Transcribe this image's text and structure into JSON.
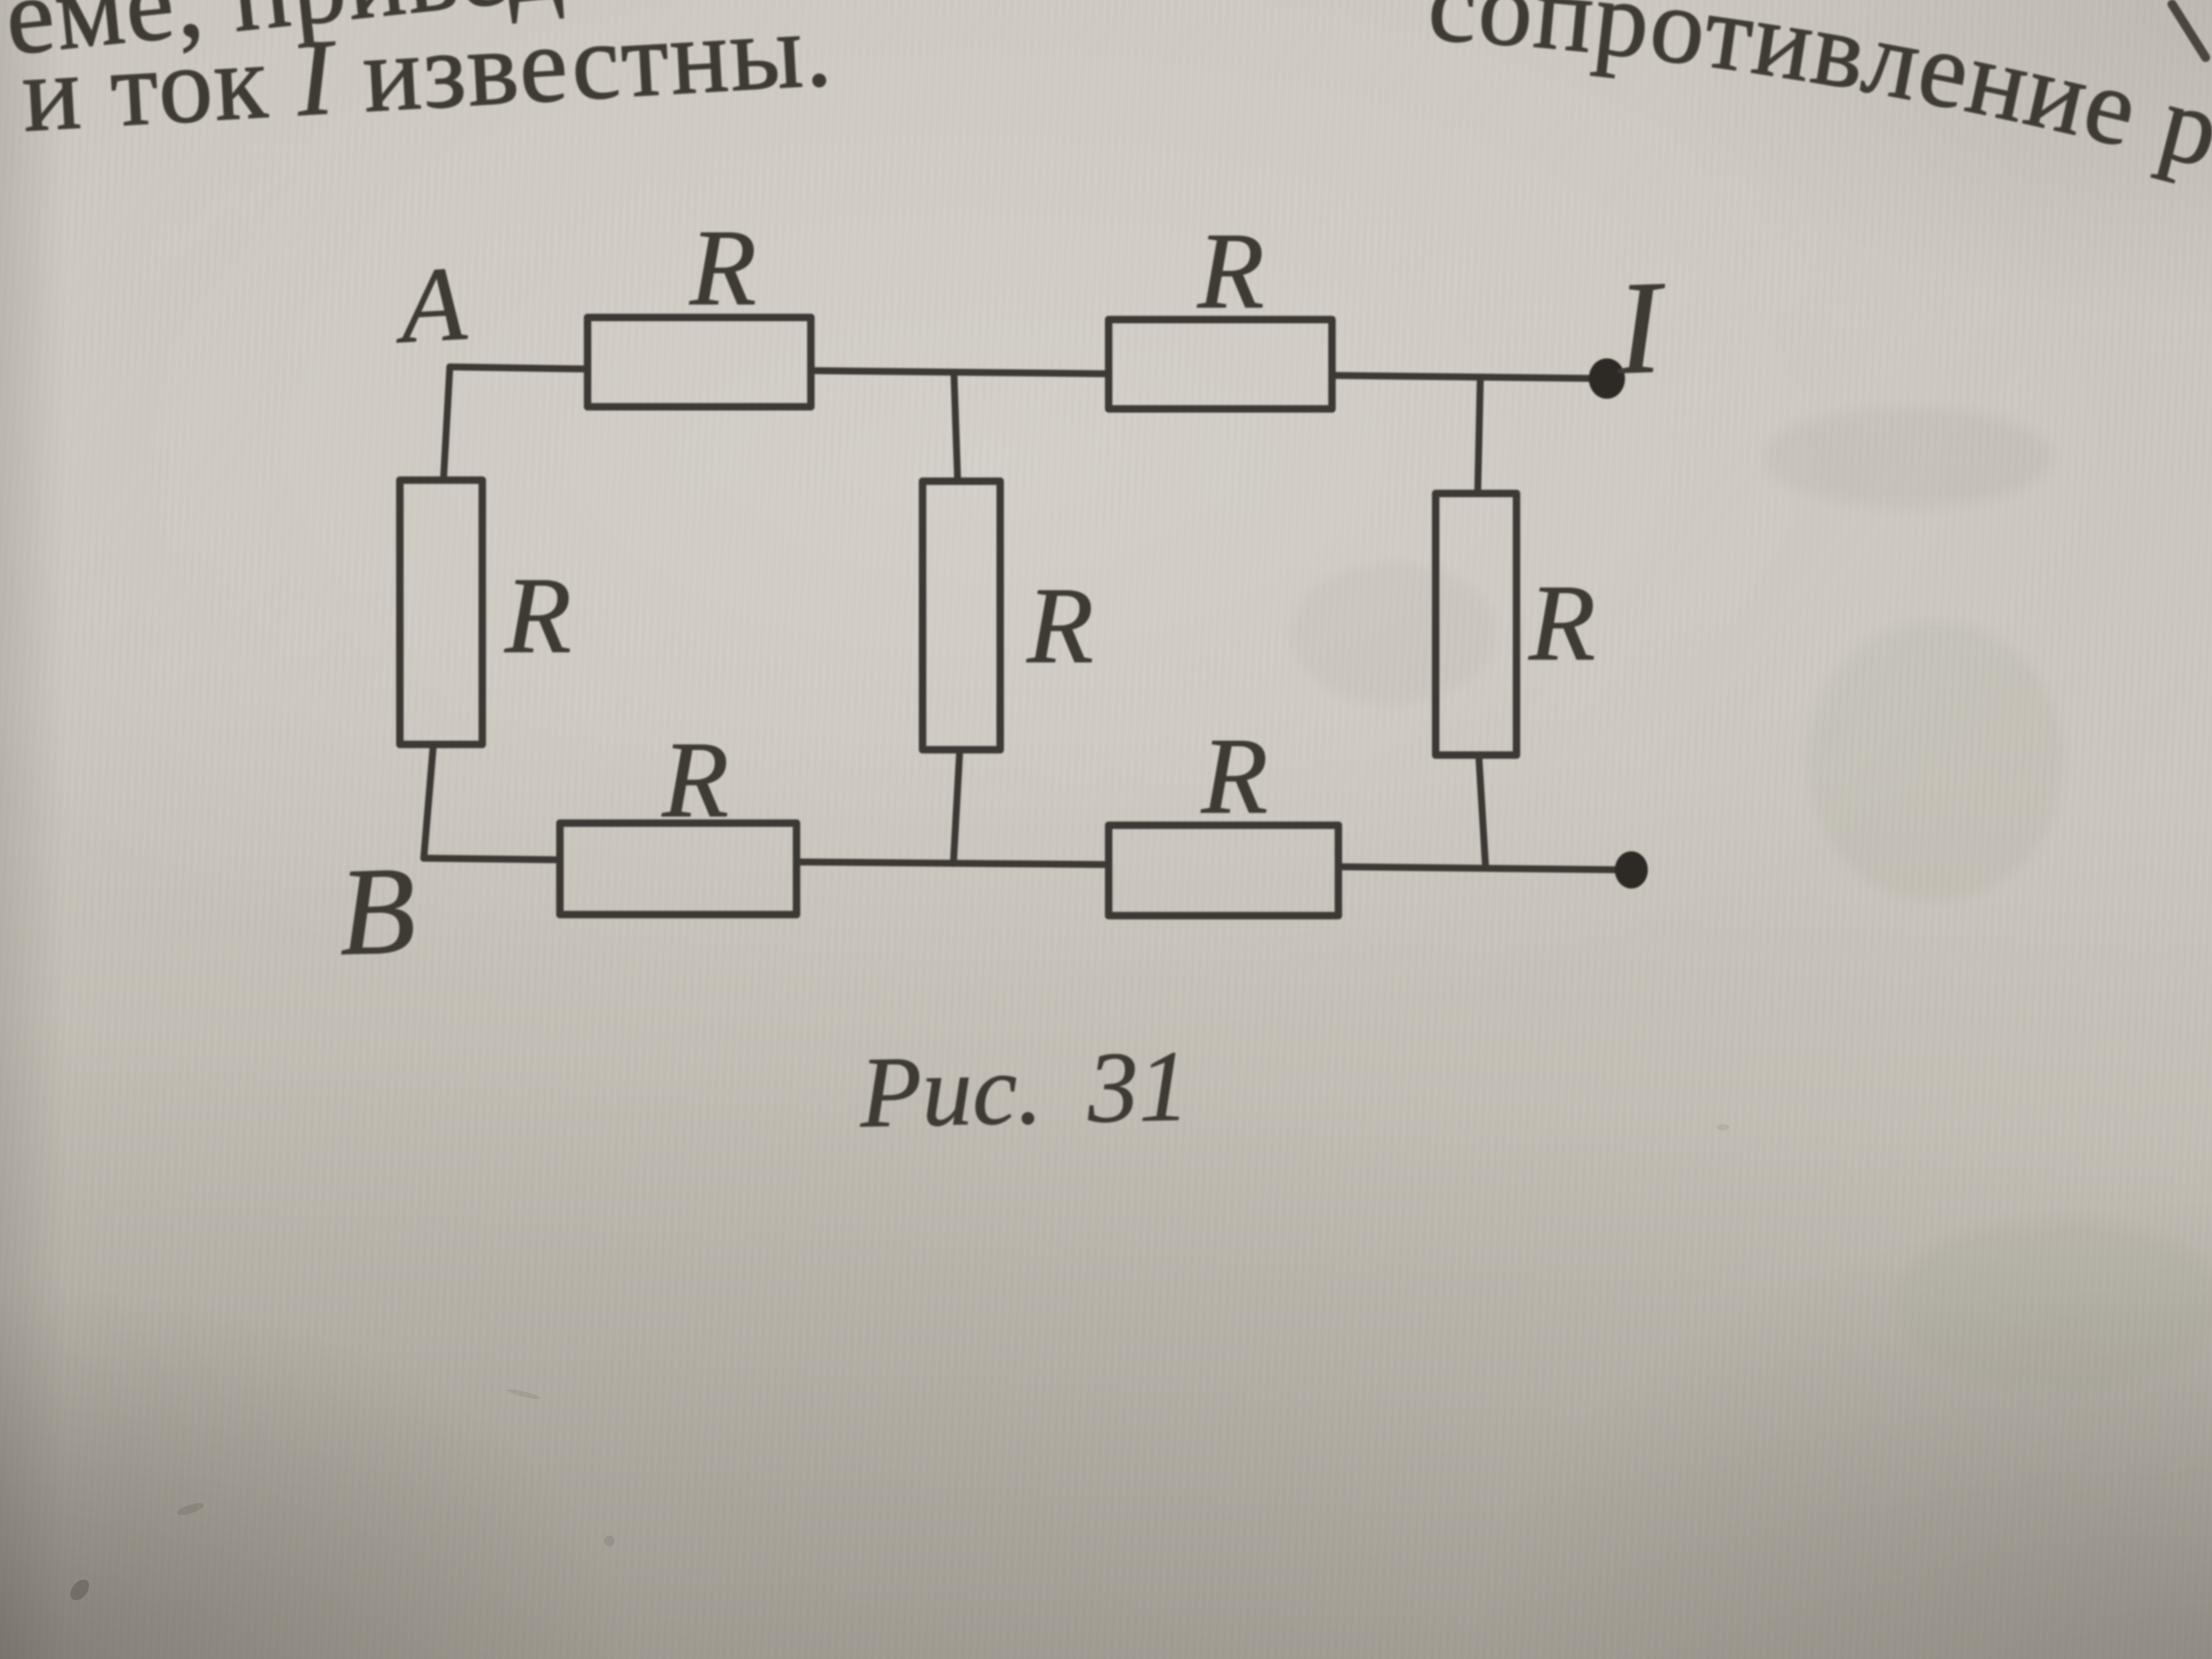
{
  "photo": {
    "paper_color": "#c9c4bc",
    "ink_color": "#3e3a34",
    "terminal_dot_color": "#2d2925"
  },
  "header_text": {
    "line1_left": "еме, приведенной",
    "line1_right": "сопротивление резист",
    "line2_pre": "и ток ",
    "line2_symbol": "I",
    "line2_post": " известны."
  },
  "figure": {
    "caption": "Рис. 31",
    "node_top_label": "A",
    "node_bottom_label": "B",
    "current_label": "I",
    "resistor_label": "R",
    "resistor_count": 7,
    "terminal_count": 2
  }
}
